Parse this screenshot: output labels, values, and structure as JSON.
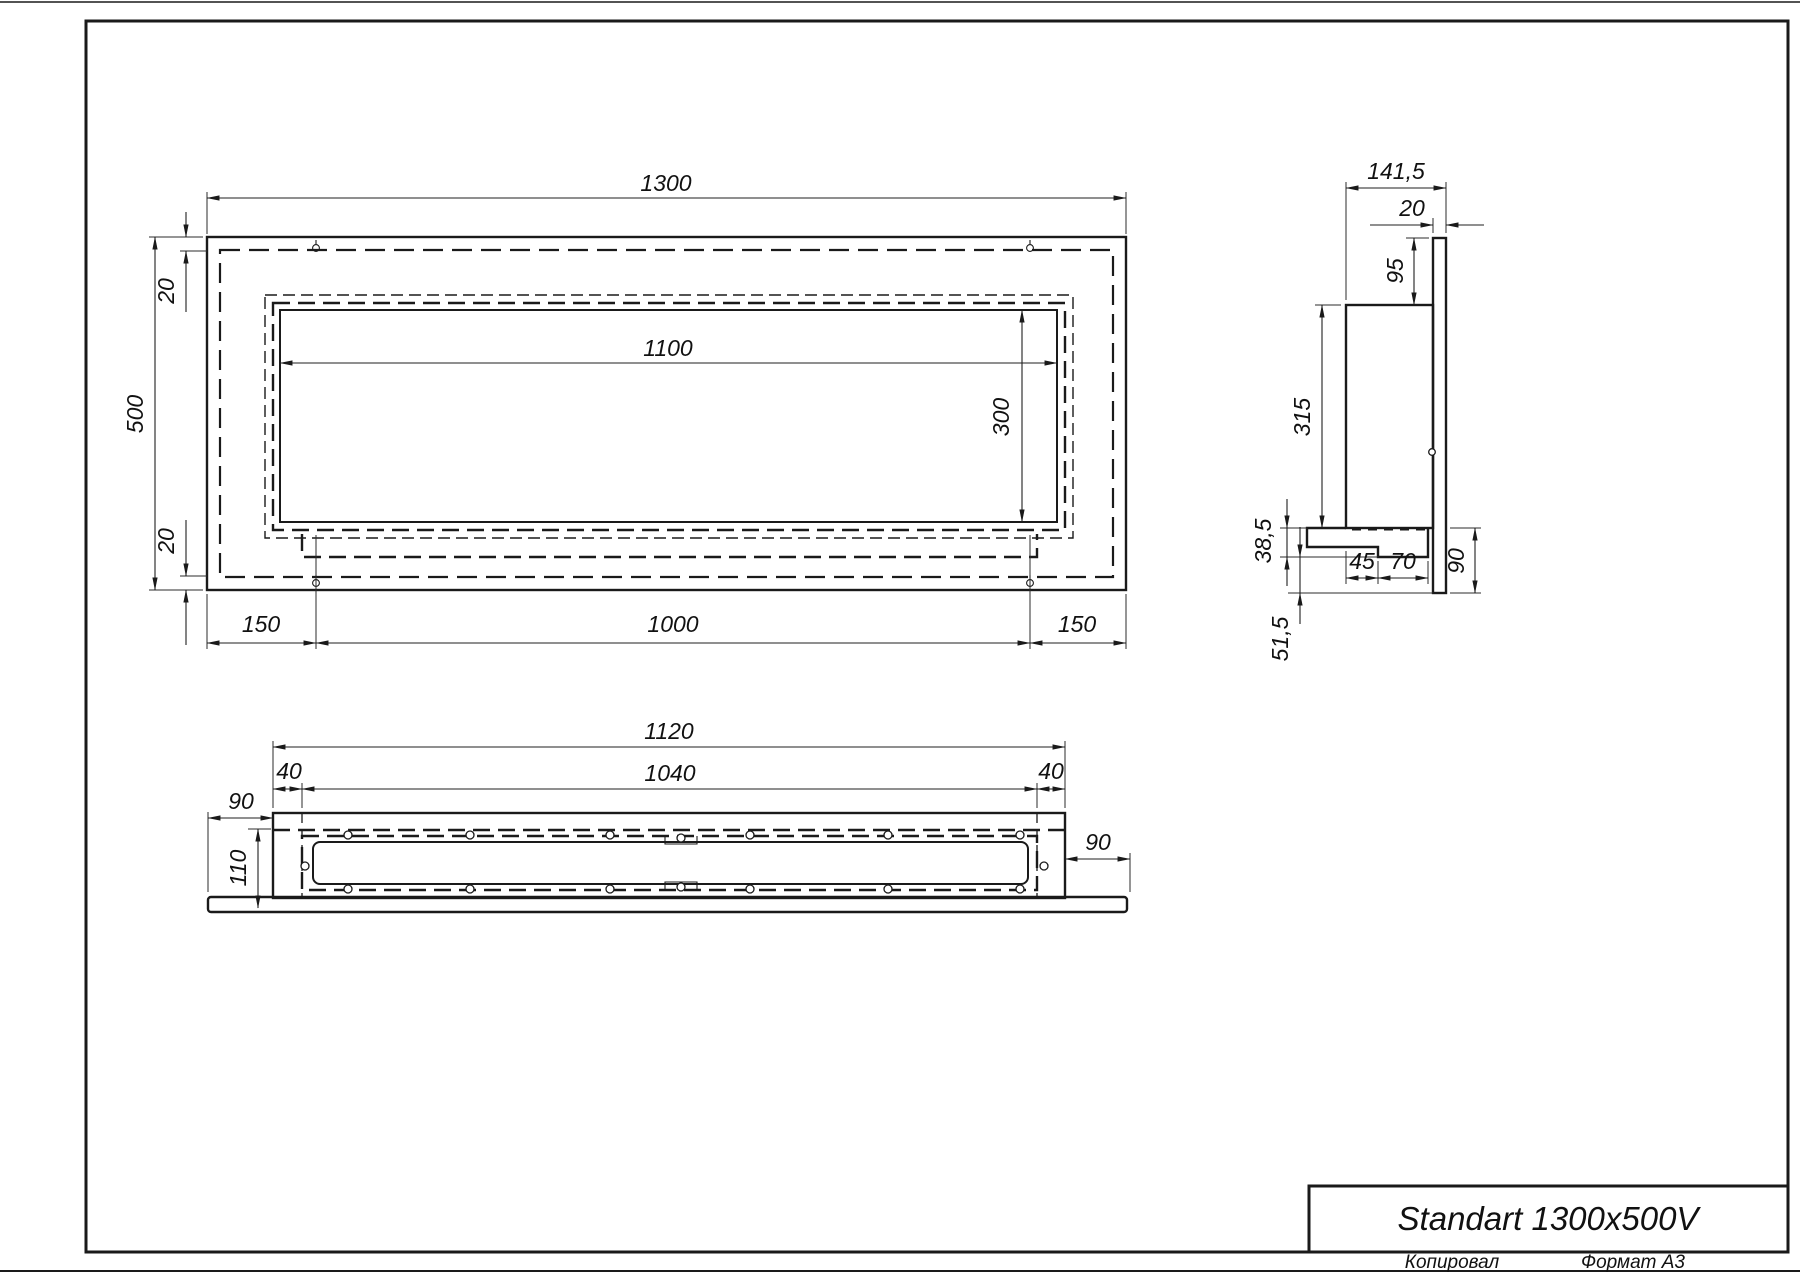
{
  "drawing": {
    "front_view": {
      "overall_width": "1300",
      "overall_height": "500",
      "top_inset": "20",
      "bottom_inset": "20",
      "opening_width": "1100",
      "opening_height": "300",
      "hole_offset_left": "150",
      "hole_spacing": "1000",
      "hole_offset_right": "150"
    },
    "side_view": {
      "overall_depth": "141,5",
      "flange_thickness": "20",
      "top_drop": "95",
      "body_height": "315",
      "bracket_height": "38,5",
      "foot_front": "45",
      "foot_back": "70",
      "flange_bottom": "90",
      "bottom_drop": "51,5"
    },
    "bottom_view": {
      "body_width": "1120",
      "opening_width": "1040",
      "side_inset_left": "40",
      "side_inset_right": "40",
      "panel_overhang_left": "90",
      "body_depth": "110",
      "panel_overhang_right": "90"
    },
    "title_block": {
      "title": "Standart 1300x500V",
      "copied_label": "Копировал",
      "format_label": "Формат А3"
    }
  }
}
